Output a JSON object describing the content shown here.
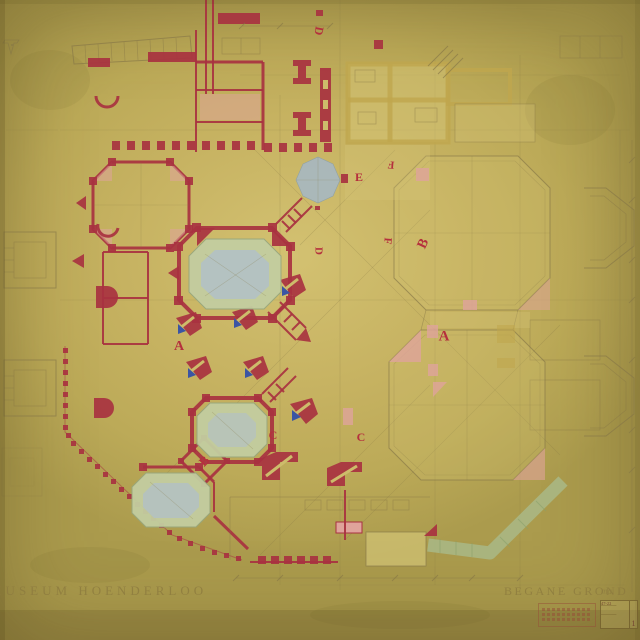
{
  "document": {
    "kind": "architectural floor plan drawing (scanned, aged paper)",
    "title_left": "MUSEUM HOENDERLOO",
    "title_right": "BEGANE GROND",
    "handwritten_note": "ma."
  },
  "stamp": {
    "number": "47-22",
    "sheet": "1"
  },
  "markers": [
    {
      "label": "A",
      "x": 179,
      "y": 347,
      "rot": 0,
      "size": 14
    },
    {
      "label": "A",
      "x": 444,
      "y": 337,
      "rot": 0,
      "size": 15
    },
    {
      "label": "B",
      "x": 204,
      "y": 461,
      "rot": -45,
      "size": 13
    },
    {
      "label": "B",
      "x": 424,
      "y": 244,
      "rot": -65,
      "size": 14
    },
    {
      "label": "C",
      "x": 273,
      "y": 435,
      "rot": 0,
      "size": 12
    },
    {
      "label": "C",
      "x": 361,
      "y": 437,
      "rot": 0,
      "size": 12
    },
    {
      "label": "D",
      "x": 319,
      "y": 31,
      "rot": 100,
      "size": 12
    },
    {
      "label": "D",
      "x": 318,
      "y": 251,
      "rot": 90,
      "size": 11
    },
    {
      "label": "E",
      "x": 359,
      "y": 177,
      "rot": 0,
      "size": 12
    },
    {
      "label": "F",
      "x": 391,
      "y": 164,
      "rot": 185,
      "size": 11
    },
    {
      "label": "F",
      "x": 387,
      "y": 241,
      "rot": 95,
      "size": 11
    }
  ],
  "palette": {
    "paper": "#c6b261",
    "paper_light": "#d3c171",
    "pencil": "#857646",
    "ink_red": "#a83240",
    "letter_red": "#b5303d",
    "pool_green": "#c3cda0",
    "pool_blue": "#b3c1c3",
    "pond_blue": "#a9b8be",
    "wash_yellow": "#d6c87a",
    "wash_ochre": "#bfa64d",
    "wash_pink": "#dfa49b",
    "accent_blue": "#3b55a4",
    "terrace_green": "#a9b987",
    "title_brown": "#8d7b3f"
  }
}
